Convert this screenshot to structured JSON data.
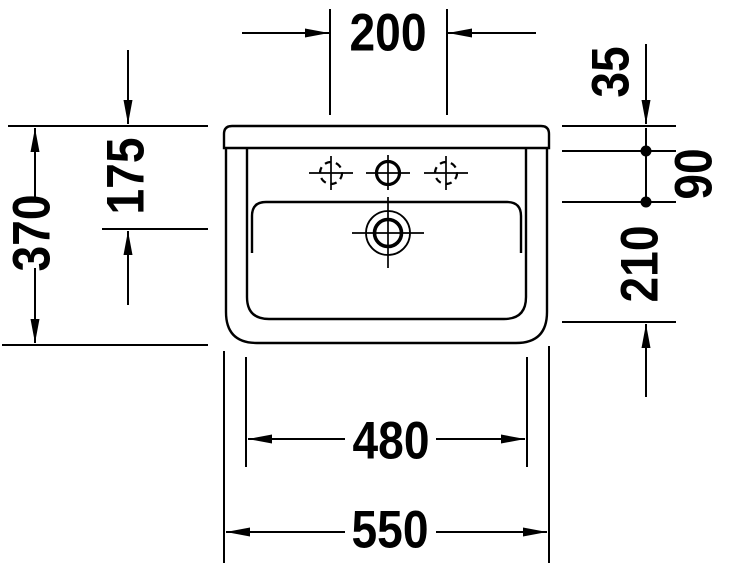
{
  "drawing": {
    "subject": "washbasin-front-view-technical-drawing",
    "unit_system": "millimeters-implied"
  },
  "dimensions": {
    "faucet_hole_spacing": "200",
    "overall_height": "370",
    "rim_to_drain_center": "175",
    "rim_to_hole_row": "35",
    "hole_row_to_bowl_edge": "90",
    "bowl_inner_depth": "210",
    "bowl_inner_width": "480",
    "overall_width": "550"
  },
  "colors": {
    "line": "#000000",
    "background": "#ffffff"
  }
}
